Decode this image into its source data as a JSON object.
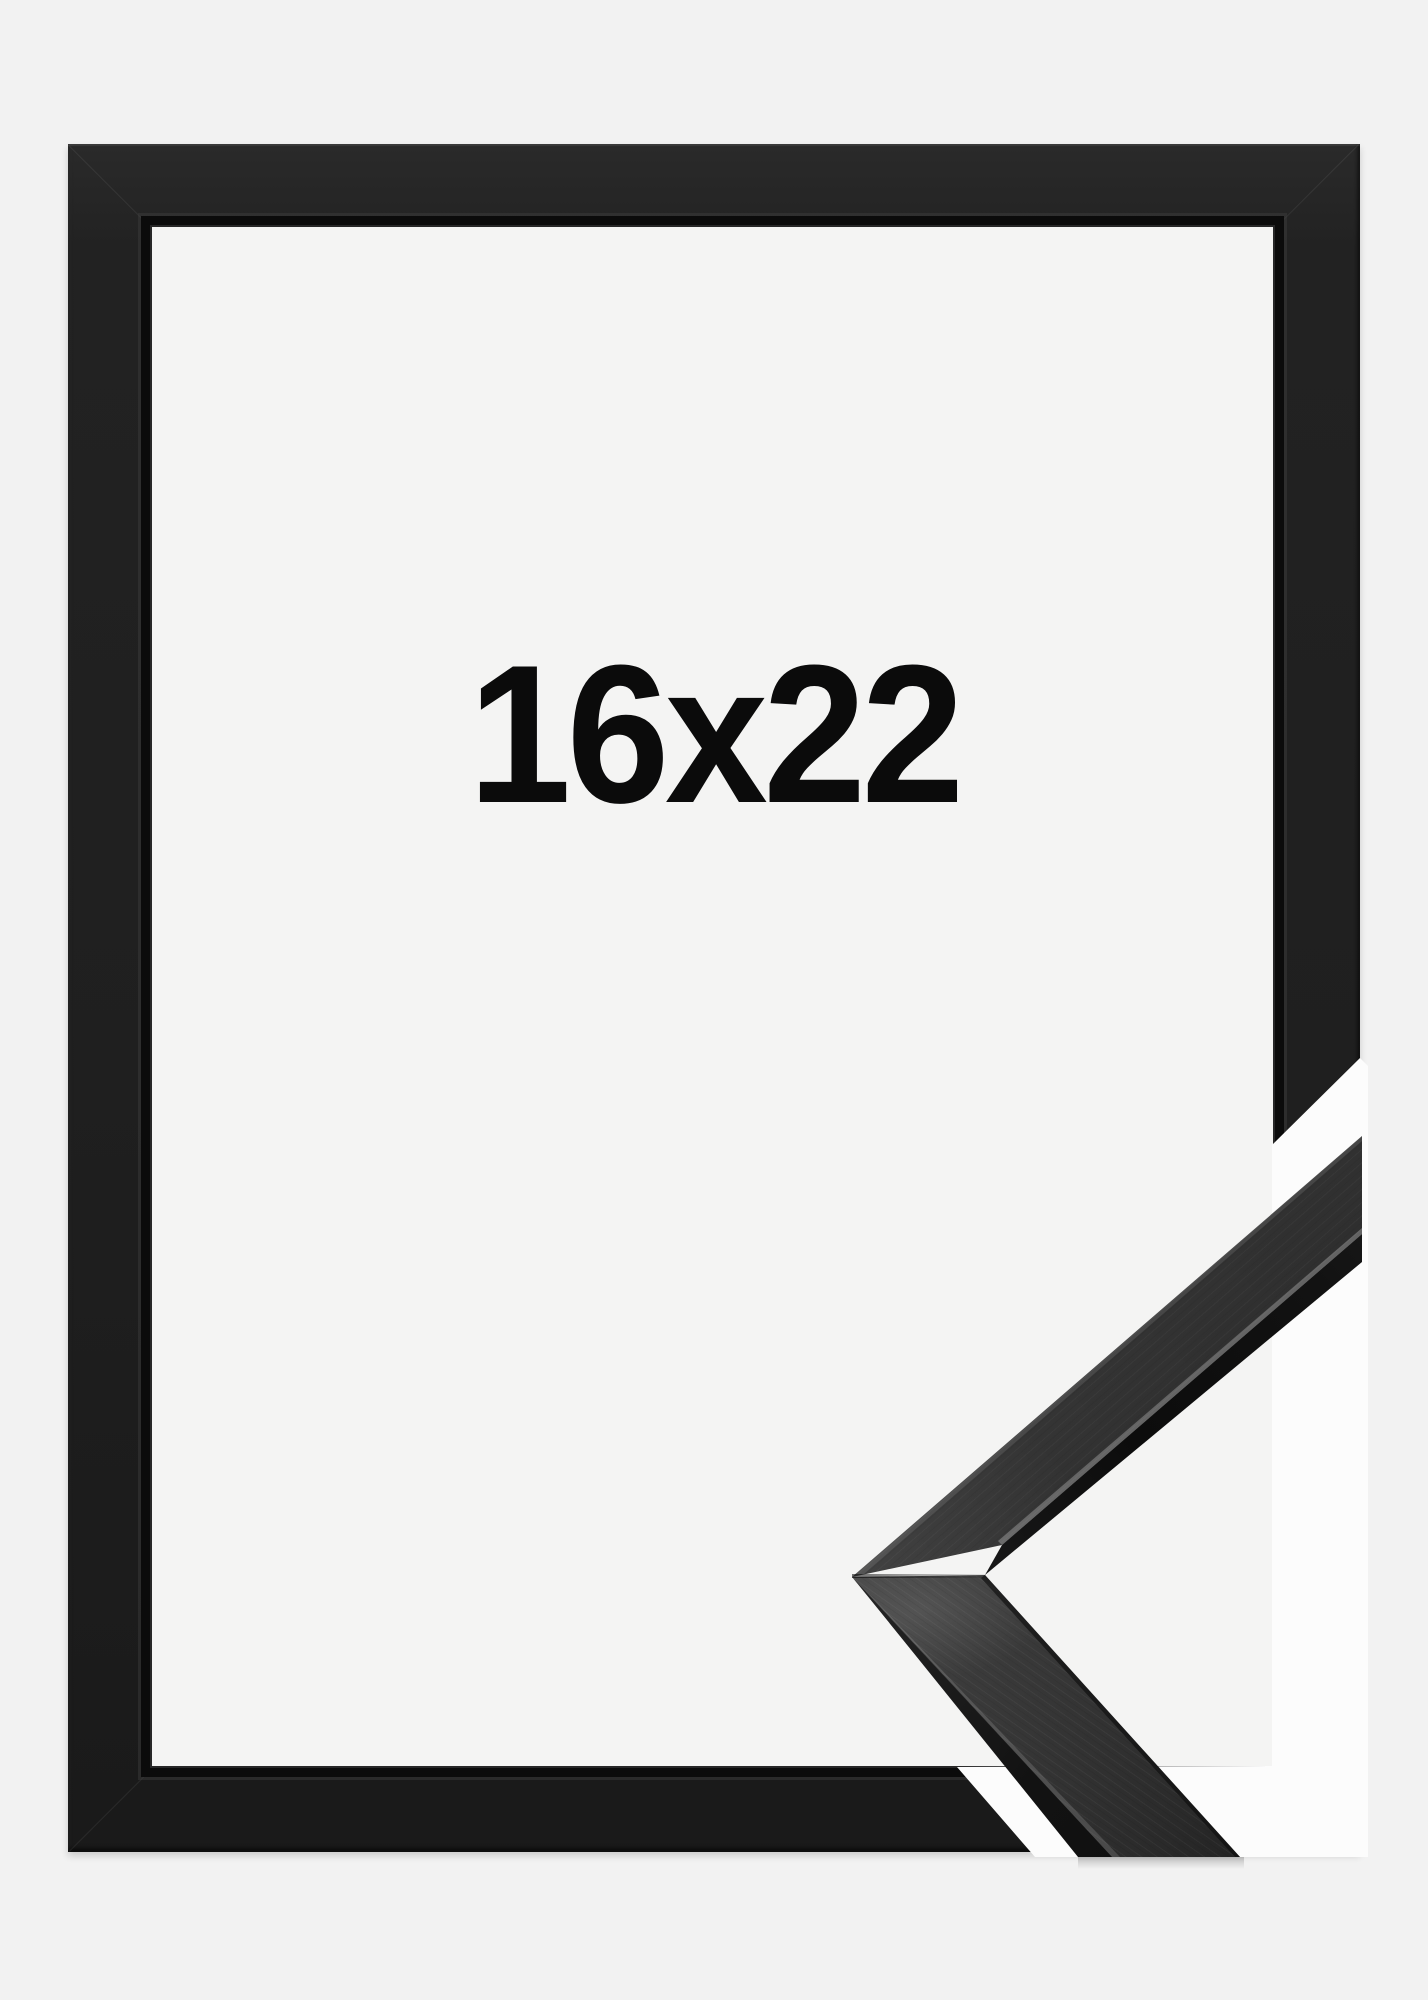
{
  "product": {
    "size_label": "16x22",
    "description": "Empty black picture frame shown flat with a diagonal corner sample of the moulding profile overlapping the bottom-right corner"
  },
  "colors": {
    "background": "#f2f2f2",
    "opening": "#f4f4f3",
    "sample_backdrop": "#fcfcfc",
    "frame_face": "#1f1f1f",
    "frame_inner_lip": "#0b0b0b",
    "moulding_face": "#383838",
    "moulding_side": "#121212",
    "label_text": "#0b0b0b"
  }
}
